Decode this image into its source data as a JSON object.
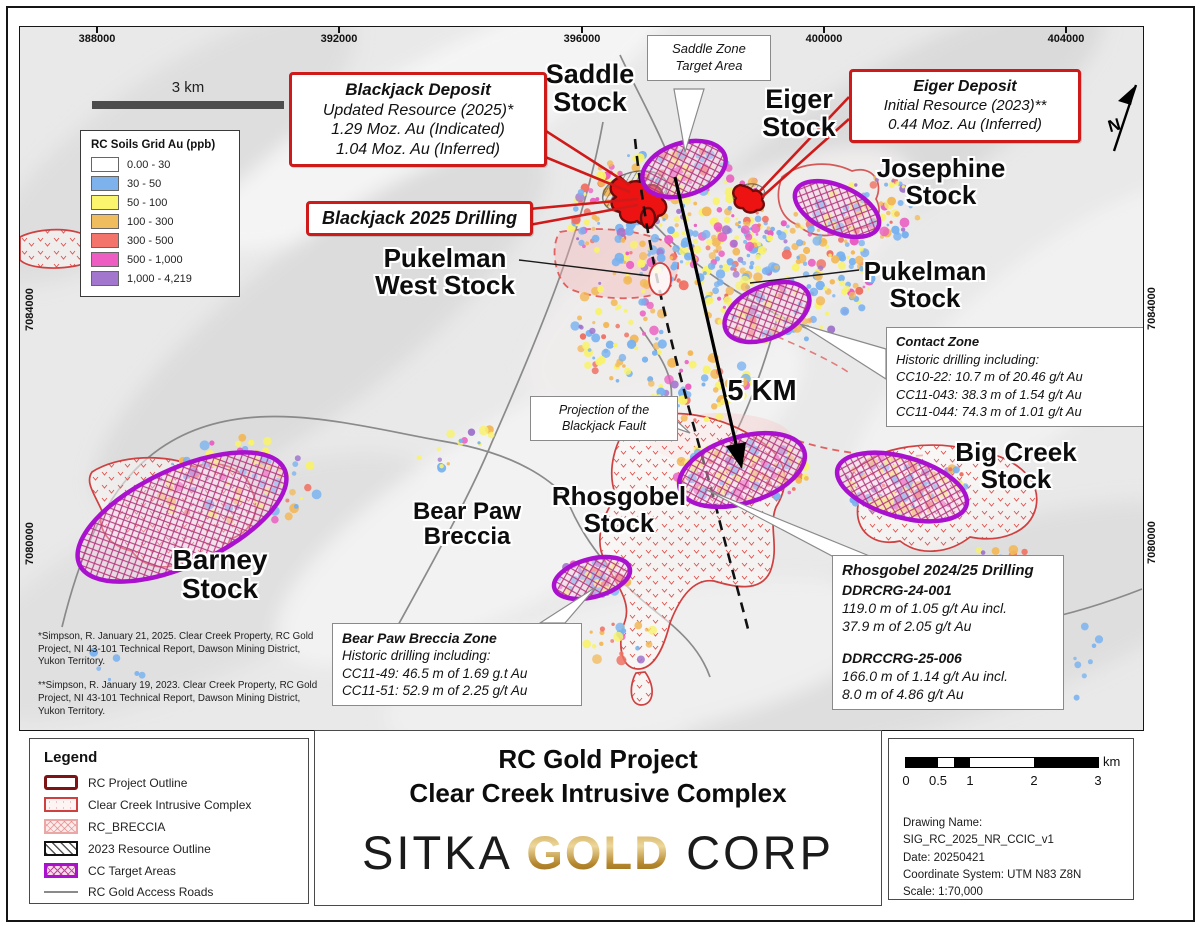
{
  "map": {
    "top_coords": [
      "388000",
      "392000",
      "396000",
      "400000",
      "404000"
    ],
    "side_coords": {
      "left_top": "7084000",
      "left_bottom": "7080000",
      "right_top": "7084000",
      "right_bottom": "7080000"
    },
    "scale_bar_label": "3 km",
    "north_label": "N",
    "soils_legend": {
      "title": "RC Soils Grid Au (ppb)",
      "items": [
        {
          "label": "0.00 - 30",
          "color": "#ffffff"
        },
        {
          "label": "30 - 50",
          "color": "#7db2ec"
        },
        {
          "label": "50 - 100",
          "color": "#faf56d"
        },
        {
          "label": "100 - 300",
          "color": "#f0bd5e"
        },
        {
          "label": "300 - 500",
          "color": "#f3746a"
        },
        {
          "label": "500 - 1,000",
          "color": "#ee5ec2"
        },
        {
          "label": "1,000 - 4,219",
          "color": "#a376cd"
        }
      ]
    },
    "callouts": {
      "blackjack": {
        "title": "Blackjack Deposit",
        "line1": "Updated Resource (2025)*",
        "line2": "1.29 Moz. Au (Indicated)",
        "line3": "1.04 Moz. Au (Inferred)"
      },
      "blackjack_drilling": {
        "label": "Blackjack 2025 Drilling"
      },
      "eiger": {
        "title": "Eiger Deposit",
        "line1": "Initial Resource (2023)**",
        "line2": "0.44 Moz. Au (Inferred)"
      },
      "saddle_zone": {
        "line1": "Saddle Zone",
        "line2": "Target Area"
      },
      "projection": {
        "line1": "Projection of the",
        "line2": "Blackjack Fault"
      },
      "contact": {
        "title": "Contact Zone",
        "subtitle": "Historic drilling including:",
        "row1": "CC10-22: 10.7 m of 20.46 g/t Au",
        "row2": "CC11-043: 38.3 m of 1.54 g/t Au",
        "row3": "CC11-044: 74.3 m of 1.01 g/t Au"
      },
      "bear_paw": {
        "title": "Bear Paw Breccia Zone",
        "subtitle": "Historic drilling including:",
        "row1": "CC11-49: 46.5 m of 1.69 g.t Au",
        "row2": "CC11-51: 52.9 m of 2.25 g/t Au"
      },
      "rhosgobel": {
        "title": "Rhosgobel 2024/25 Drilling",
        "hole1": "DDRCRG-24-001",
        "h1r1": "119.0 m of 1.05 g/t Au incl.",
        "h1r2": "37.9 m of 2.05 g/t Au",
        "hole2": "DDRCCRG-25-006",
        "h2r1": "166.0 m of 1.14 g/t Au incl.",
        "h2r2": "8.0 m of 4.86 g/t Au"
      }
    },
    "labels": {
      "saddle": {
        "l1": "Saddle",
        "l2": "Stock"
      },
      "eiger": {
        "l1": "Eiger",
        "l2": "Stock"
      },
      "josephine": {
        "l1": "Josephine",
        "l2": "Stock"
      },
      "pukelman_west": {
        "l1": "Pukelman",
        "l2": "West Stock"
      },
      "pukelman": {
        "l1": "Pukelman",
        "l2": "Stock"
      },
      "big_creek": {
        "l1": "Big Creek",
        "l2": "Stock"
      },
      "rhosgobel": {
        "l1": "Rhosgobel",
        "l2": "Stock"
      },
      "bear_paw": {
        "l1": "Bear Paw",
        "l2": "Breccia"
      },
      "barney": {
        "l1": "Barney",
        "l2": "Stock"
      },
      "distance": "5 KM"
    },
    "footnotes": {
      "note1": "*Simpson, R.  January 21, 2025.  Clear Creek Property, RC Gold Project, NI 43-101 Technical Report, Dawson Mining District, Yukon Territory.",
      "note2": "**Simpson, R.  January 19, 2023.  Clear Creek Property, RC Gold Project, NI 43-101 Technical Report, Dawson Mining District, Yukon Territory."
    }
  },
  "footer": {
    "legend": {
      "title": "Legend",
      "items": [
        {
          "label": "RC Project Outline"
        },
        {
          "label": "Clear Creek Intrusive Complex"
        },
        {
          "label": "RC_BRECCIA"
        },
        {
          "label": "2023 Resource Outline"
        },
        {
          "label": "CC Target Areas"
        },
        {
          "label": "RC Gold Access Roads"
        }
      ]
    },
    "title": {
      "line1": "RC Gold Project",
      "line2": "Clear Creek Intrusive Complex"
    },
    "logo": {
      "sitka": "SITKA ",
      "gold": "GOLD",
      "corp": " CORP"
    },
    "info": {
      "ticks": [
        "0",
        "0.5",
        "1",
        "2",
        "3"
      ],
      "unit": "km",
      "line1": "Drawing Name: SIG_RC_2025_NR_CCIC_v1",
      "line2": "Date: 20250421",
      "line3": "Coordinate System: UTM N83 Z8N",
      "line4": "Scale: 1:70,000"
    }
  },
  "colors": {
    "callout_border_red": "#cf1a1a",
    "deposit_red": "#ee1313",
    "cc_target_purple": "#a911cf",
    "ccic_outline_red": "#cf4040",
    "project_outline_dark_red": "#7c1416",
    "road_gray": "#8a8a8a",
    "logo_gold": "#b4862c"
  }
}
